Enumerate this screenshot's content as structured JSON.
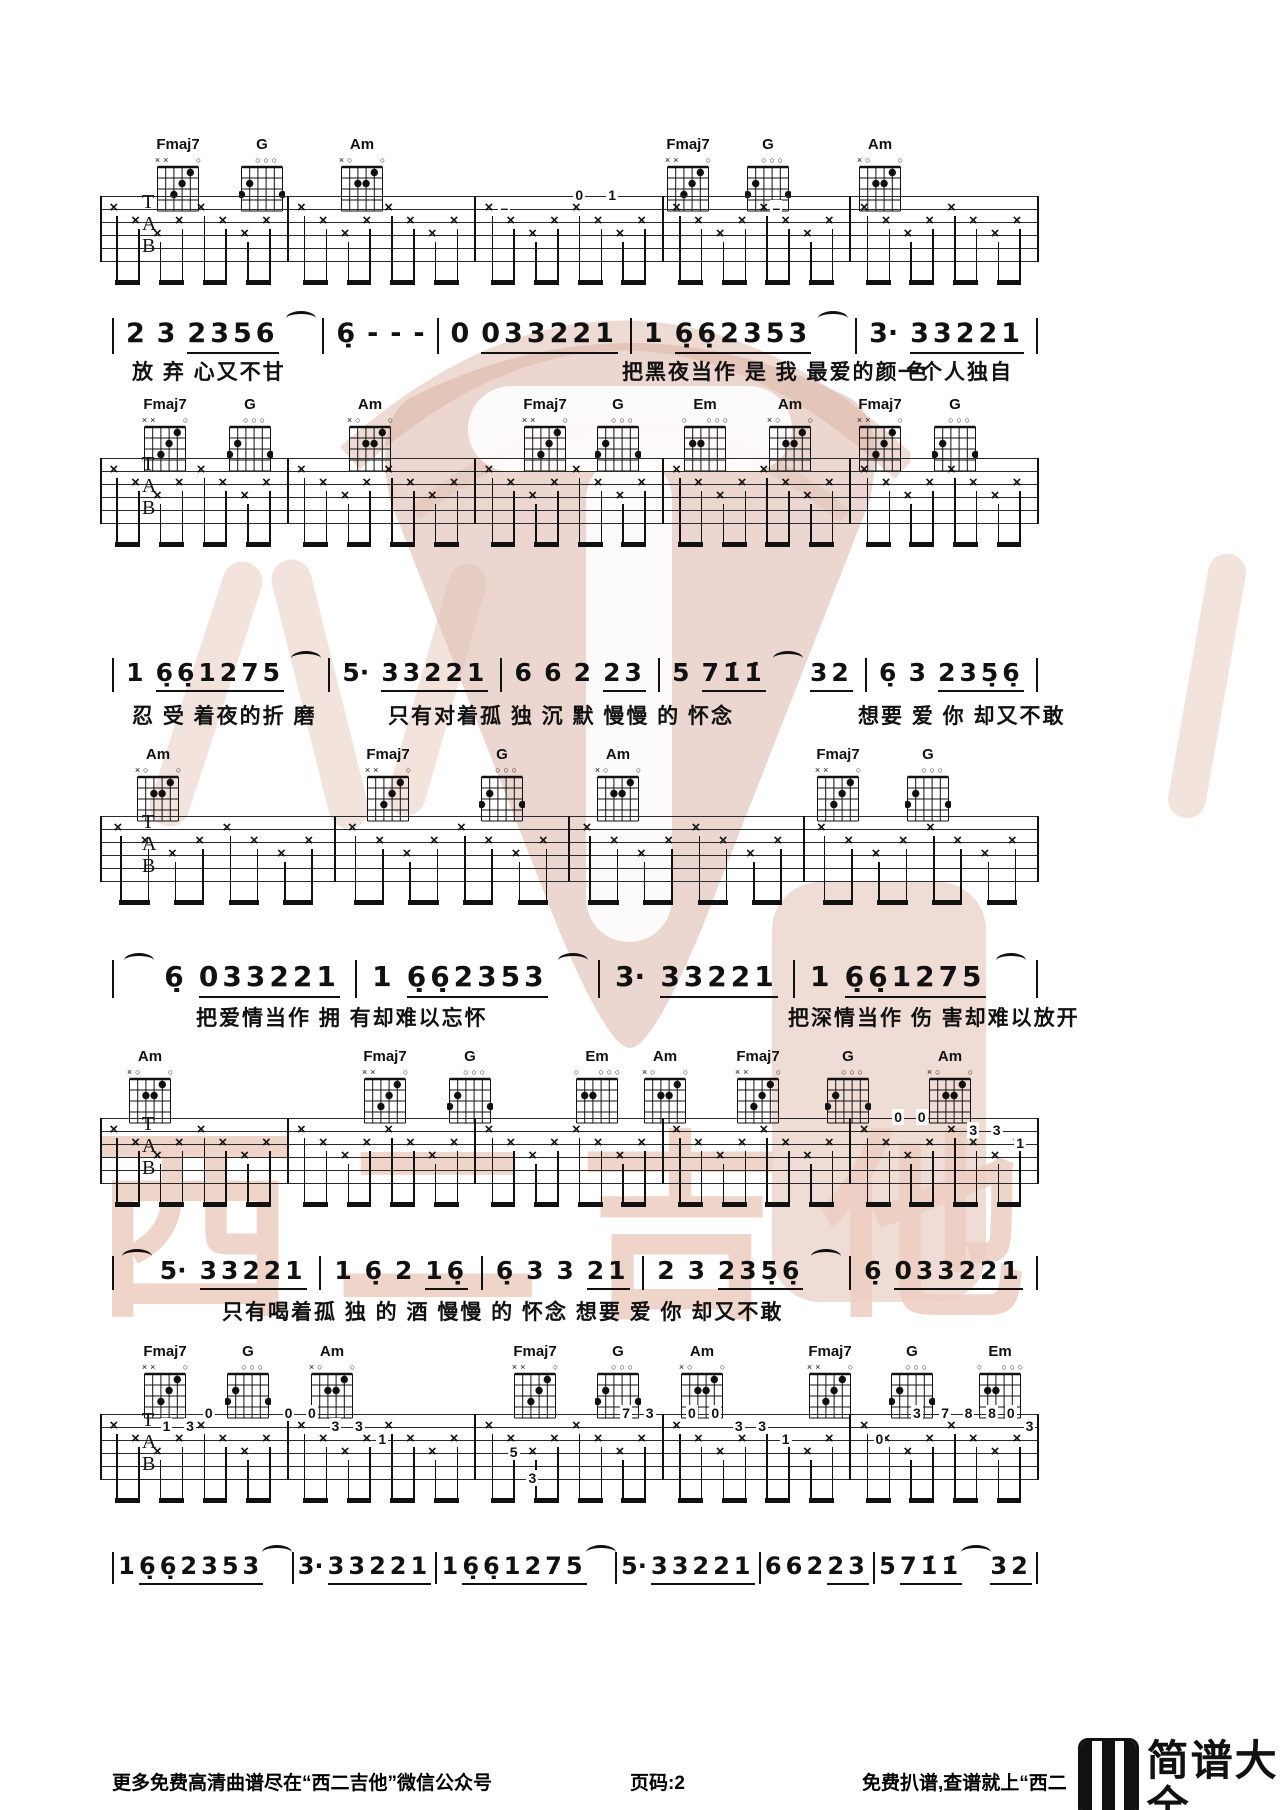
{
  "watermark": {
    "text": "西二吉他"
  },
  "footer": {
    "left": "更多免费高清曲谱尽在“西二吉他”微信公众号",
    "center": "页码:2",
    "right": "免费扒谱,查谱就上“西二",
    "brand": "简谱大全",
    "brand_url": "jianpudq.com"
  },
  "chord_shapes": {
    "Fmaj7": {
      "markers": [
        "x",
        "x",
        "",
        "",
        "",
        "o"
      ],
      "dots": [
        [
          5,
          1
        ],
        [
          4,
          2
        ],
        [
          3,
          3
        ]
      ]
    },
    "G": {
      "markers": [
        "",
        "",
        "o",
        "o",
        "o",
        ""
      ],
      "dots": [
        [
          2,
          2
        ],
        [
          1,
          3
        ],
        [
          6,
          3
        ]
      ]
    },
    "Am": {
      "markers": [
        "x",
        "o",
        "",
        "",
        "",
        "o"
      ],
      "dots": [
        [
          5,
          1
        ],
        [
          3,
          2
        ],
        [
          4,
          2
        ]
      ]
    },
    "Em": {
      "markers": [
        "o",
        "",
        "",
        "o",
        "o",
        "o"
      ],
      "dots": [
        [
          2,
          2
        ],
        [
          3,
          2
        ]
      ]
    }
  },
  "systems": [
    {
      "chords_y": 138,
      "staff_y": 196,
      "measures": 5,
      "chords": [
        {
          "name": "Fmaj7",
          "x": 178
        },
        {
          "name": "G",
          "x": 262
        },
        {
          "name": "Am",
          "x": 362
        },
        {
          "name": "Fmaj7",
          "x": 688
        },
        {
          "name": "G",
          "x": 768
        },
        {
          "name": "Am",
          "x": 880
        }
      ],
      "frets": [
        {
          "x": 43,
          "l": 1,
          "t": "–"
        },
        {
          "x": 51,
          "l": 0,
          "t": "0"
        },
        {
          "x": 54.5,
          "l": 0,
          "t": "1"
        },
        {
          "x": 72,
          "l": 1,
          "t": "–"
        }
      ],
      "melody": {
        "y": 318,
        "fs": 27,
        "tokens": [
          {
            "bar": 1
          },
          {
            "t": "2"
          },
          {
            "t": "3"
          },
          {
            "t": "2356",
            "u": 1
          },
          {
            "tie": 1
          },
          {
            "bar": 1
          },
          {
            "t": "6̣"
          },
          {
            "t": "-"
          },
          {
            "t": "-"
          },
          {
            "t": "-"
          },
          {
            "bar": 1
          },
          {
            "t": "0"
          },
          {
            "t": "033221",
            "u": 1
          },
          {
            "bar": 1
          },
          {
            "t": "1"
          },
          {
            "t": "6̣6̣2353",
            "u": 1
          },
          {
            "tie": 1
          },
          {
            "bar": 1
          },
          {
            "t": "3·"
          },
          {
            "t": "33221",
            "u": 1
          },
          {
            "bar": 1
          }
        ]
      },
      "lyrics": {
        "y": 356,
        "segments": [
          {
            "x": 132,
            "t": "放 弃 心又不甘"
          },
          {
            "x": 622,
            "t": "把黑夜当作 是 我 最爱的颜 色"
          },
          {
            "x": 898,
            "t": "一个人独自"
          }
        ]
      }
    },
    {
      "chords_y": 398,
      "staff_y": 458,
      "measures": 5,
      "chords": [
        {
          "name": "Fmaj7",
          "x": 165
        },
        {
          "name": "G",
          "x": 250
        },
        {
          "name": "Am",
          "x": 370
        },
        {
          "name": "Fmaj7",
          "x": 545
        },
        {
          "name": "G",
          "x": 618
        },
        {
          "name": "Em",
          "x": 705
        },
        {
          "name": "Am",
          "x": 790
        },
        {
          "name": "Fmaj7",
          "x": 880
        },
        {
          "name": "G",
          "x": 955
        }
      ],
      "frets": [],
      "melody": {
        "y": 658,
        "fs": 25,
        "tokens": [
          {
            "bar": 1
          },
          {
            "t": "1"
          },
          {
            "t": "6̣6̣1275",
            "u": 1
          },
          {
            "tie": 1
          },
          {
            "bar": 1
          },
          {
            "t": "5·"
          },
          {
            "t": "33221",
            "u": 1
          },
          {
            "bar": 1
          },
          {
            "t": "6"
          },
          {
            "t": "6"
          },
          {
            "t": "2"
          },
          {
            "t": "23",
            "u": 1
          },
          {
            "bar": 1
          },
          {
            "t": "5"
          },
          {
            "t": "71̇1̇",
            "u": 1
          },
          {
            "tie": 1
          },
          {
            "t": "32",
            "u": 1
          },
          {
            "bar": 1
          },
          {
            "t": "6̣"
          },
          {
            "t": "3"
          },
          {
            "t": "235̣6̣",
            "u": 1
          },
          {
            "bar": 1
          }
        ]
      },
      "lyrics": {
        "y": 700,
        "segments": [
          {
            "x": 132,
            "t": "忍 受 着夜的折 磨"
          },
          {
            "x": 388,
            "t": "只有对着孤 独 沉 默 慢慢 的 怀念"
          },
          {
            "x": 858,
            "t": "想要 爱 你 却又不敢"
          }
        ]
      }
    },
    {
      "chords_y": 748,
      "staff_y": 816,
      "measures": 4,
      "chords": [
        {
          "name": "Am",
          "x": 158
        },
        {
          "name": "Fmaj7",
          "x": 388
        },
        {
          "name": "G",
          "x": 502
        },
        {
          "name": "Am",
          "x": 618
        },
        {
          "name": "Fmaj7",
          "x": 838
        },
        {
          "name": "G",
          "x": 928
        }
      ],
      "frets": [],
      "melody": {
        "y": 960,
        "fs": 28,
        "tokens": [
          {
            "bar": 1
          },
          {
            "tie": 1
          },
          {
            "t": "6̣"
          },
          {
            "t": "033221",
            "u": 1
          },
          {
            "bar": 1
          },
          {
            "t": "1"
          },
          {
            "t": "6̣6̣2353",
            "u": 1
          },
          {
            "tie": 1
          },
          {
            "bar": 1
          },
          {
            "t": "3·"
          },
          {
            "t": "33221",
            "u": 1
          },
          {
            "bar": 1
          },
          {
            "t": "1"
          },
          {
            "t": "6̣6̣1275",
            "u": 1
          },
          {
            "tie": 1
          },
          {
            "bar": 1
          }
        ]
      },
      "lyrics": {
        "y": 1002,
        "segments": [
          {
            "x": 196,
            "t": "把爱情当作 拥 有却难以忘怀"
          },
          {
            "x": 788,
            "t": "把深情当作 伤 害却难以放开"
          }
        ]
      }
    },
    {
      "chords_y": 1050,
      "staff_y": 1118,
      "measures": 5,
      "chords": [
        {
          "name": "Am",
          "x": 150
        },
        {
          "name": "Fmaj7",
          "x": 385
        },
        {
          "name": "G",
          "x": 470
        },
        {
          "name": "Em",
          "x": 597
        },
        {
          "name": "Am",
          "x": 665
        },
        {
          "name": "Fmaj7",
          "x": 758
        },
        {
          "name": "G",
          "x": 848
        },
        {
          "name": "Am",
          "x": 950
        }
      ],
      "frets": [
        {
          "x": 85,
          "l": 0,
          "t": "0"
        },
        {
          "x": 87.5,
          "l": 0,
          "t": "0"
        },
        {
          "x": 93,
          "l": 1,
          "t": "3"
        },
        {
          "x": 95.5,
          "l": 1,
          "t": "3"
        },
        {
          "x": 98,
          "l": 2,
          "t": "1"
        }
      ],
      "melody": {
        "y": 1256,
        "fs": 25,
        "tokens": [
          {
            "bar": 1
          },
          {
            "tie": 1
          },
          {
            "t": "5·"
          },
          {
            "t": "33221",
            "u": 1
          },
          {
            "bar": 1
          },
          {
            "t": "1"
          },
          {
            "t": "6̣"
          },
          {
            "t": "2"
          },
          {
            "t": "16̣",
            "u": 1
          },
          {
            "bar": 1
          },
          {
            "t": "6̣"
          },
          {
            "t": "3"
          },
          {
            "t": "3"
          },
          {
            "t": "21",
            "u": 1
          },
          {
            "bar": 1
          },
          {
            "t": "2"
          },
          {
            "t": "3"
          },
          {
            "t": "235̣6̣",
            "u": 1
          },
          {
            "tie": 1
          },
          {
            "bar": 1
          },
          {
            "t": "6̣"
          },
          {
            "t": "033221",
            "u": 1
          },
          {
            "bar": 1
          }
        ]
      },
      "lyrics": {
        "y": 1296,
        "segments": [
          {
            "x": 222,
            "t": "只有喝着孤 独 的 酒 慢慢 的 怀念 想要 爱 你 却又不敢"
          }
        ]
      }
    },
    {
      "chords_y": 1345,
      "staff_y": 1414,
      "measures": 5,
      "chords": [
        {
          "name": "Fmaj7",
          "x": 165
        },
        {
          "name": "G",
          "x": 248
        },
        {
          "name": "Am",
          "x": 332
        },
        {
          "name": "Fmaj7",
          "x": 535
        },
        {
          "name": "G",
          "x": 618
        },
        {
          "name": "Am",
          "x": 702
        },
        {
          "name": "Fmaj7",
          "x": 830
        },
        {
          "name": "G",
          "x": 912
        },
        {
          "name": "Em",
          "x": 1000
        }
      ],
      "frets": [
        {
          "x": 7,
          "l": 1,
          "t": "1"
        },
        {
          "x": 9.5,
          "l": 1,
          "t": "3"
        },
        {
          "x": 11.5,
          "l": 0,
          "t": "0"
        },
        {
          "x": 20,
          "l": 0,
          "t": "0"
        },
        {
          "x": 22.5,
          "l": 0,
          "t": "0"
        },
        {
          "x": 25,
          "l": 1,
          "t": "3"
        },
        {
          "x": 27.5,
          "l": 1,
          "t": "3"
        },
        {
          "x": 30,
          "l": 2,
          "t": "1"
        },
        {
          "x": 44,
          "l": 3,
          "t": "5"
        },
        {
          "x": 46,
          "l": 5,
          "t": "3"
        },
        {
          "x": 56,
          "l": 0,
          "t": "7"
        },
        {
          "x": 58.5,
          "l": 0,
          "t": "3"
        },
        {
          "x": 63,
          "l": 0,
          "t": "0"
        },
        {
          "x": 65.5,
          "l": 0,
          "t": "0"
        },
        {
          "x": 68,
          "l": 1,
          "t": "3"
        },
        {
          "x": 70.5,
          "l": 1,
          "t": "3"
        },
        {
          "x": 73,
          "l": 2,
          "t": "1"
        },
        {
          "x": 83,
          "l": 2,
          "t": "0"
        },
        {
          "x": 87,
          "l": 0,
          "t": "3"
        },
        {
          "x": 90,
          "l": 0,
          "t": "7"
        },
        {
          "x": 92.5,
          "l": 0,
          "t": "8"
        },
        {
          "x": 95,
          "l": 0,
          "t": "8"
        },
        {
          "x": 97,
          "l": 0,
          "t": "0"
        },
        {
          "x": 99,
          "l": 1,
          "t": "3"
        }
      ],
      "melody": {
        "y": 1552,
        "fs": 24,
        "tokens": [
          {
            "bar": 1
          },
          {
            "t": "1"
          },
          {
            "t": "6̣6̣2353",
            "u": 1
          },
          {
            "tie": 1
          },
          {
            "bar": 1
          },
          {
            "t": "3·"
          },
          {
            "t": "33221",
            "u": 1
          },
          {
            "bar": 1
          },
          {
            "t": "1"
          },
          {
            "t": "6̣6̣1275",
            "u": 1
          },
          {
            "tie": 1
          },
          {
            "bar": 1
          },
          {
            "t": "5·"
          },
          {
            "t": "33221",
            "u": 1
          },
          {
            "bar": 1
          },
          {
            "t": "6"
          },
          {
            "t": "6"
          },
          {
            "t": "2"
          },
          {
            "t": "23",
            "u": 1
          },
          {
            "bar": 1
          },
          {
            "t": "5"
          },
          {
            "t": "71̇1̇",
            "u": 1
          },
          {
            "tie": 1
          },
          {
            "t": "32",
            "u": 1
          },
          {
            "bar": 1
          }
        ]
      },
      "lyrics": null
    }
  ]
}
